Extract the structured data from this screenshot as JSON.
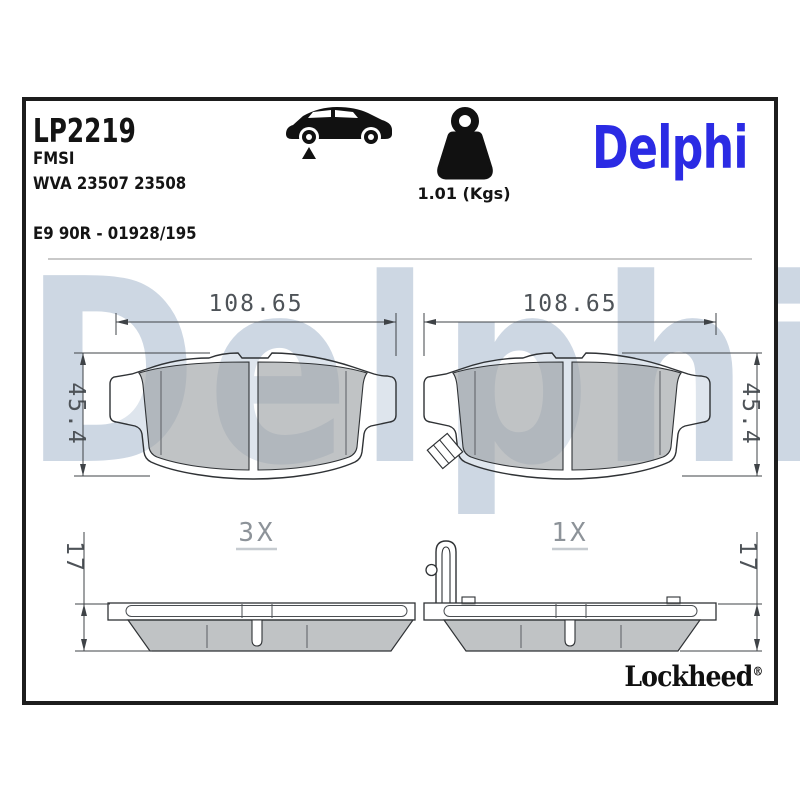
{
  "header": {
    "part_number": "LP2219",
    "fmsi_label": "FMSI",
    "wva_numbers": "WVA 23507 23508",
    "homologation": "E9 90R - 01928/195",
    "weight": "1.01 (Kgs)",
    "brand_logo": "Delphi"
  },
  "watermark_text": "Delphi",
  "footer": {
    "brand_logo": "Lockheed",
    "registered_mark": "®"
  },
  "drawings": {
    "pad_front_left": {
      "width_mm": "108.65",
      "height_mm": "45.4"
    },
    "pad_front_right": {
      "width_mm": "108.65",
      "height_mm": "45.4"
    },
    "pad_side_left": {
      "thickness_mm": "17",
      "quantity": "3X"
    },
    "pad_side_right": {
      "thickness_mm": "17",
      "quantity": "1X"
    }
  },
  "icons": {
    "car": "car-silhouette-icon",
    "weight": "weight-kettlebell-icon"
  },
  "colors": {
    "brand_blue": "#2b2be4",
    "watermark_blue": "#cdd7e3",
    "friction_gray": "#bfc2c5",
    "outline_dark": "#2f3235",
    "dim_text": "#4e5358",
    "quantity_text": "#8d9399"
  }
}
